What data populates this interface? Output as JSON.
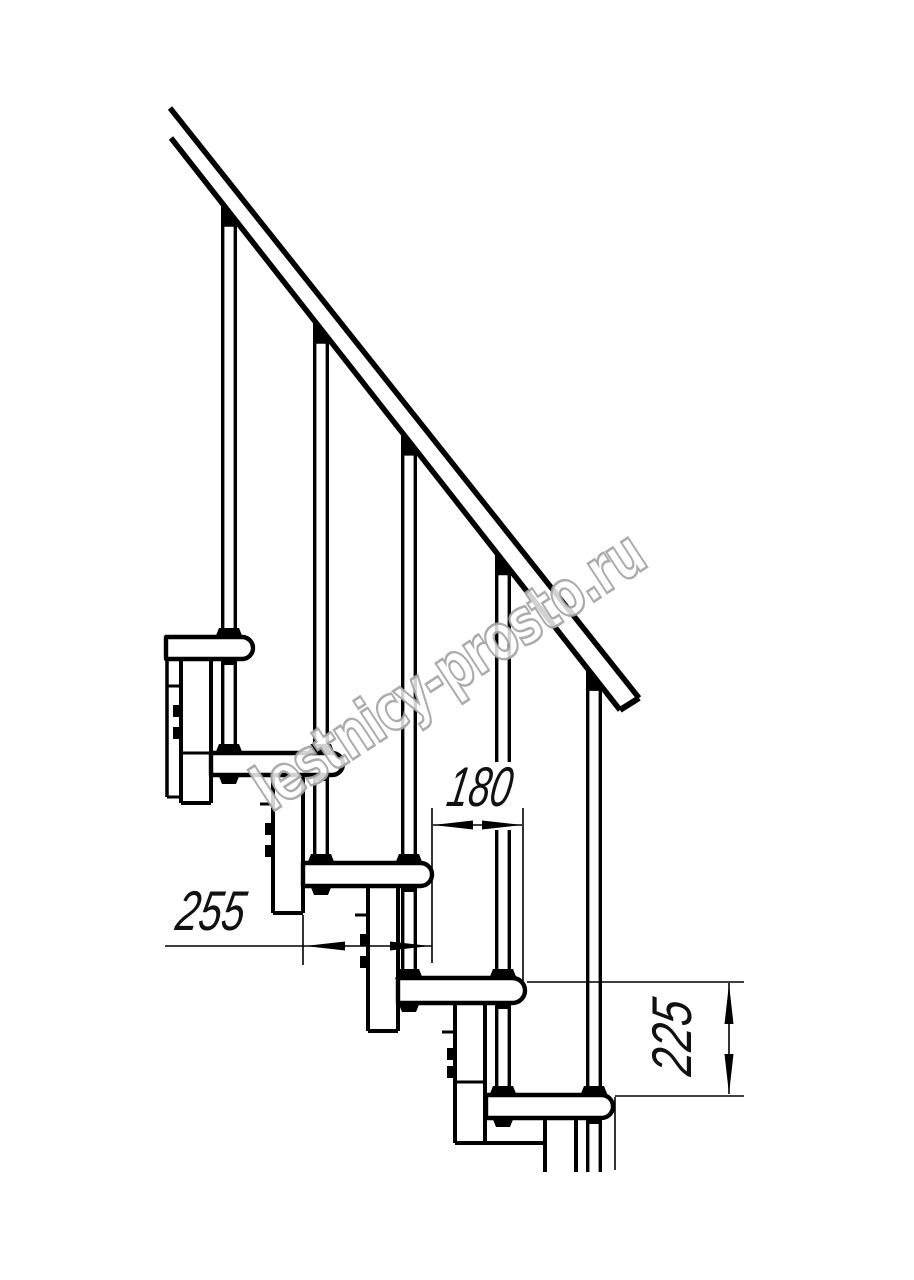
{
  "title": "Modular staircase side-view technical drawing",
  "watermark": {
    "text": "lestnicy-prosto.ru",
    "stroke_color": "#a3a3a3",
    "fill_color": "#ffffff",
    "x": 271,
    "y": 813,
    "angle": -33.2,
    "font_size": 64,
    "length": 452
  },
  "dimensions": {
    "step_run": {
      "value": "180"
    },
    "tread_depth": {
      "value": "255"
    },
    "riser_height": {
      "value": "225"
    }
  },
  "colors": {
    "line": "#000000",
    "dim_text": "#111111",
    "background": "#ffffff"
  },
  "geometry": {
    "rail": {
      "upper": [
        170,
        108,
        639,
        698
      ],
      "lower": [
        171,
        138,
        620,
        710
      ],
      "cap": [
        639,
        698,
        620,
        710
      ],
      "slope": 1.2717,
      "lower_origin": [
        171,
        138
      ]
    },
    "treads": [
      {
        "left": 166,
        "right": 253,
        "top": 637,
        "h": 22,
        "cut_left": true
      },
      {
        "left": 211,
        "right": 343,
        "top": 753,
        "h": 22
      },
      {
        "left": 303,
        "right": 432,
        "top": 863,
        "h": 23
      },
      {
        "left": 398,
        "right": 525,
        "top": 978,
        "h": 25
      },
      {
        "left": 486,
        "right": 613,
        "top": 1095,
        "h": 23
      }
    ],
    "boxes": [
      {
        "l": 181,
        "r": 211,
        "top": 659,
        "bot": 803,
        "internal": 753
      },
      {
        "l": 273,
        "r": 303,
        "top": 775,
        "bot": 913
      },
      {
        "l": 368,
        "r": 398,
        "top": 886,
        "bot": 1031
      },
      {
        "l": 455,
        "r": 485,
        "top": 1003,
        "bot": 1143,
        "bot_right": 543,
        "internal": 1082
      },
      {
        "l": 545,
        "r": 576,
        "top": 1118,
        "bot": 1172,
        "open": true
      }
    ],
    "tabs": [
      [
        168,
        181,
        686
      ],
      [
        260,
        273,
        804
      ],
      [
        355,
        368,
        915
      ],
      [
        442,
        455,
        1032
      ]
    ],
    "clips": [
      [
        173,
        705
      ],
      [
        173,
        727
      ],
      [
        265,
        823
      ],
      [
        265,
        845
      ],
      [
        360,
        934
      ],
      [
        360,
        956
      ],
      [
        447,
        1048
      ],
      [
        447,
        1066
      ]
    ],
    "left_cut": {
      "x": 167,
      "y1": 637,
      "y2": 797,
      "tick_x2": 181
    },
    "rods": [
      {
        "cx": 229,
        "segs": [
          [
            222,
            629
          ],
          [
            659,
            744
          ]
        ]
      },
      {
        "cx": 321,
        "segs": [
          [
            339,
            744
          ],
          [
            775,
            854
          ]
        ]
      },
      {
        "cx": 409,
        "segs": [
          [
            452,
            854
          ],
          [
            886,
            969
          ]
        ]
      },
      {
        "cx": 503,
        "segs": [
          [
            569,
            969
          ],
          [
            1003,
            1086
          ]
        ]
      },
      {
        "cx": 594,
        "segs": [
          [
            686,
            1086
          ],
          [
            1118,
            1172
          ]
        ]
      }
    ],
    "tread_collars": [
      [
        229,
        637
      ],
      [
        229,
        753
      ],
      [
        321,
        753
      ],
      [
        321,
        863
      ],
      [
        409,
        863
      ],
      [
        409,
        978
      ],
      [
        503,
        978
      ],
      [
        503,
        1095
      ],
      [
        594,
        1095
      ]
    ],
    "end_nuts": [
      [
        229,
        775
      ],
      [
        321,
        886
      ],
      [
        409,
        1003
      ],
      [
        503,
        1118
      ]
    ],
    "pass_nubs": [
      [
        229,
        659
      ],
      [
        321,
        775
      ],
      [
        409,
        886
      ],
      [
        503,
        1003
      ],
      [
        594,
        1118
      ]
    ],
    "extra_thin_lines": [
      [
        615,
        1097,
        1170
      ]
    ],
    "dim180": {
      "mask": [
        446,
        762,
        70,
        68
      ],
      "ext": [
        [
          432,
          808,
          963
        ],
        [
          523,
          808,
          983
        ]
      ],
      "line": {
        "y": 825,
        "x1": 433,
        "x2": 522
      },
      "arrows": [
        {
          "tip": [
            433,
            825
          ],
          "dir": "left"
        },
        {
          "tip": [
            522,
            825
          ],
          "dir": "right"
        }
      ],
      "text": {
        "x": 477,
        "y": 806,
        "len": 64
      }
    },
    "dim255": {
      "ext": [
        [
          303,
          915,
          965
        ]
      ],
      "line": {
        "y": 946,
        "x1": 165,
        "x2": 432
      },
      "arrows": [
        {
          "tip": [
            305,
            946
          ],
          "dir": "left"
        },
        {
          "tip": [
            430,
            946
          ],
          "dir": "right"
        }
      ],
      "text": {
        "x": 208,
        "y": 930,
        "len": 68
      }
    },
    "dim225": {
      "ext_h": [
        [
          982,
          527,
          744
        ],
        [
          1096,
          615,
          744
        ]
      ],
      "line": {
        "x": 729,
        "y1": 983,
        "y2": 1094
      },
      "arrows": [
        {
          "tip": [
            729,
            984
          ],
          "dir": "up"
        },
        {
          "tip": [
            729,
            1094
          ],
          "dir": "down"
        }
      ],
      "text": {
        "x": 691,
        "y": 1040,
        "len": 74,
        "rotate": -90
      }
    }
  }
}
